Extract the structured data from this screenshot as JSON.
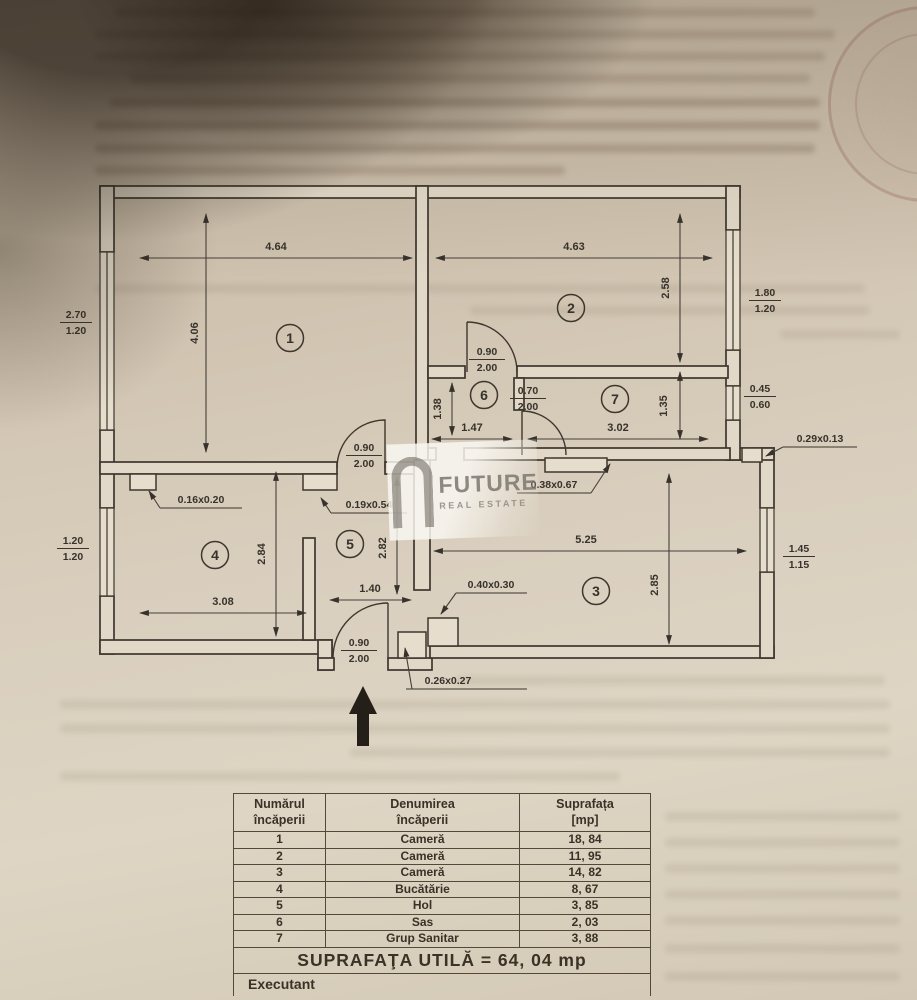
{
  "watermark": {
    "title": "FUTURE",
    "subtitle": "REAL ESTATE"
  },
  "plan": {
    "room_numbers": [
      "1",
      "2",
      "3",
      "4",
      "5",
      "6",
      "7"
    ],
    "dims": {
      "r1w": "4.64",
      "r1h": "4.06",
      "r2w": "4.63",
      "r2h": "2.58",
      "r3w": "5.25",
      "r3h": "2.85",
      "r4w": "3.08",
      "r4h": "2.84",
      "r5w": "1.40",
      "r5h": "2.82",
      "r6w": "1.47",
      "r6h": "1.38",
      "r7w": "3.02",
      "r7h": "1.35"
    },
    "windows": {
      "room1": {
        "a": "2.70",
        "b": "1.20"
      },
      "room4": {
        "a": "1.20",
        "b": "1.20"
      },
      "room2": {
        "a": "1.80",
        "b": "1.20"
      },
      "room7": {
        "a": "0.45",
        "b": "0.60"
      },
      "room3": {
        "a": "1.45",
        "b": "1.15"
      }
    },
    "doors": {
      "room1": {
        "a": "0.90",
        "b": "2.00"
      },
      "room2": {
        "a": "0.90",
        "b": "2.00"
      },
      "bath": {
        "a": "0.70",
        "b": "2.00"
      },
      "entry": {
        "a": "0.90",
        "b": "2.00"
      }
    },
    "notes": {
      "n1": "0.16x0.20",
      "n2": "0.19x0.54",
      "n3": "0.38x0.67",
      "n4": "0.40x0.30",
      "n5": "0.29x0.13",
      "n6": "0.26x0.27"
    }
  },
  "table": {
    "headers": [
      {
        "l1": "Numărul",
        "l2": "încăperii"
      },
      {
        "l1": "Denumirea",
        "l2": "încăperii"
      },
      {
        "l1": "Suprafața",
        "l2": "[mp]"
      }
    ],
    "rows": [
      [
        "1",
        "Cameră",
        "18, 84"
      ],
      [
        "2",
        "Cameră",
        "11, 95"
      ],
      [
        "3",
        "Cameră",
        "14, 82"
      ],
      [
        "4",
        "Bucătărie",
        "8, 67"
      ],
      [
        "5",
        "Hol",
        "3, 85"
      ],
      [
        "6",
        "Sas",
        "2, 03"
      ],
      [
        "7",
        "Grup Sanitar",
        "3, 88"
      ]
    ],
    "total": "SUPRAFAŢA UTILĂ = 64, 04 mp",
    "footer": "Executant"
  }
}
